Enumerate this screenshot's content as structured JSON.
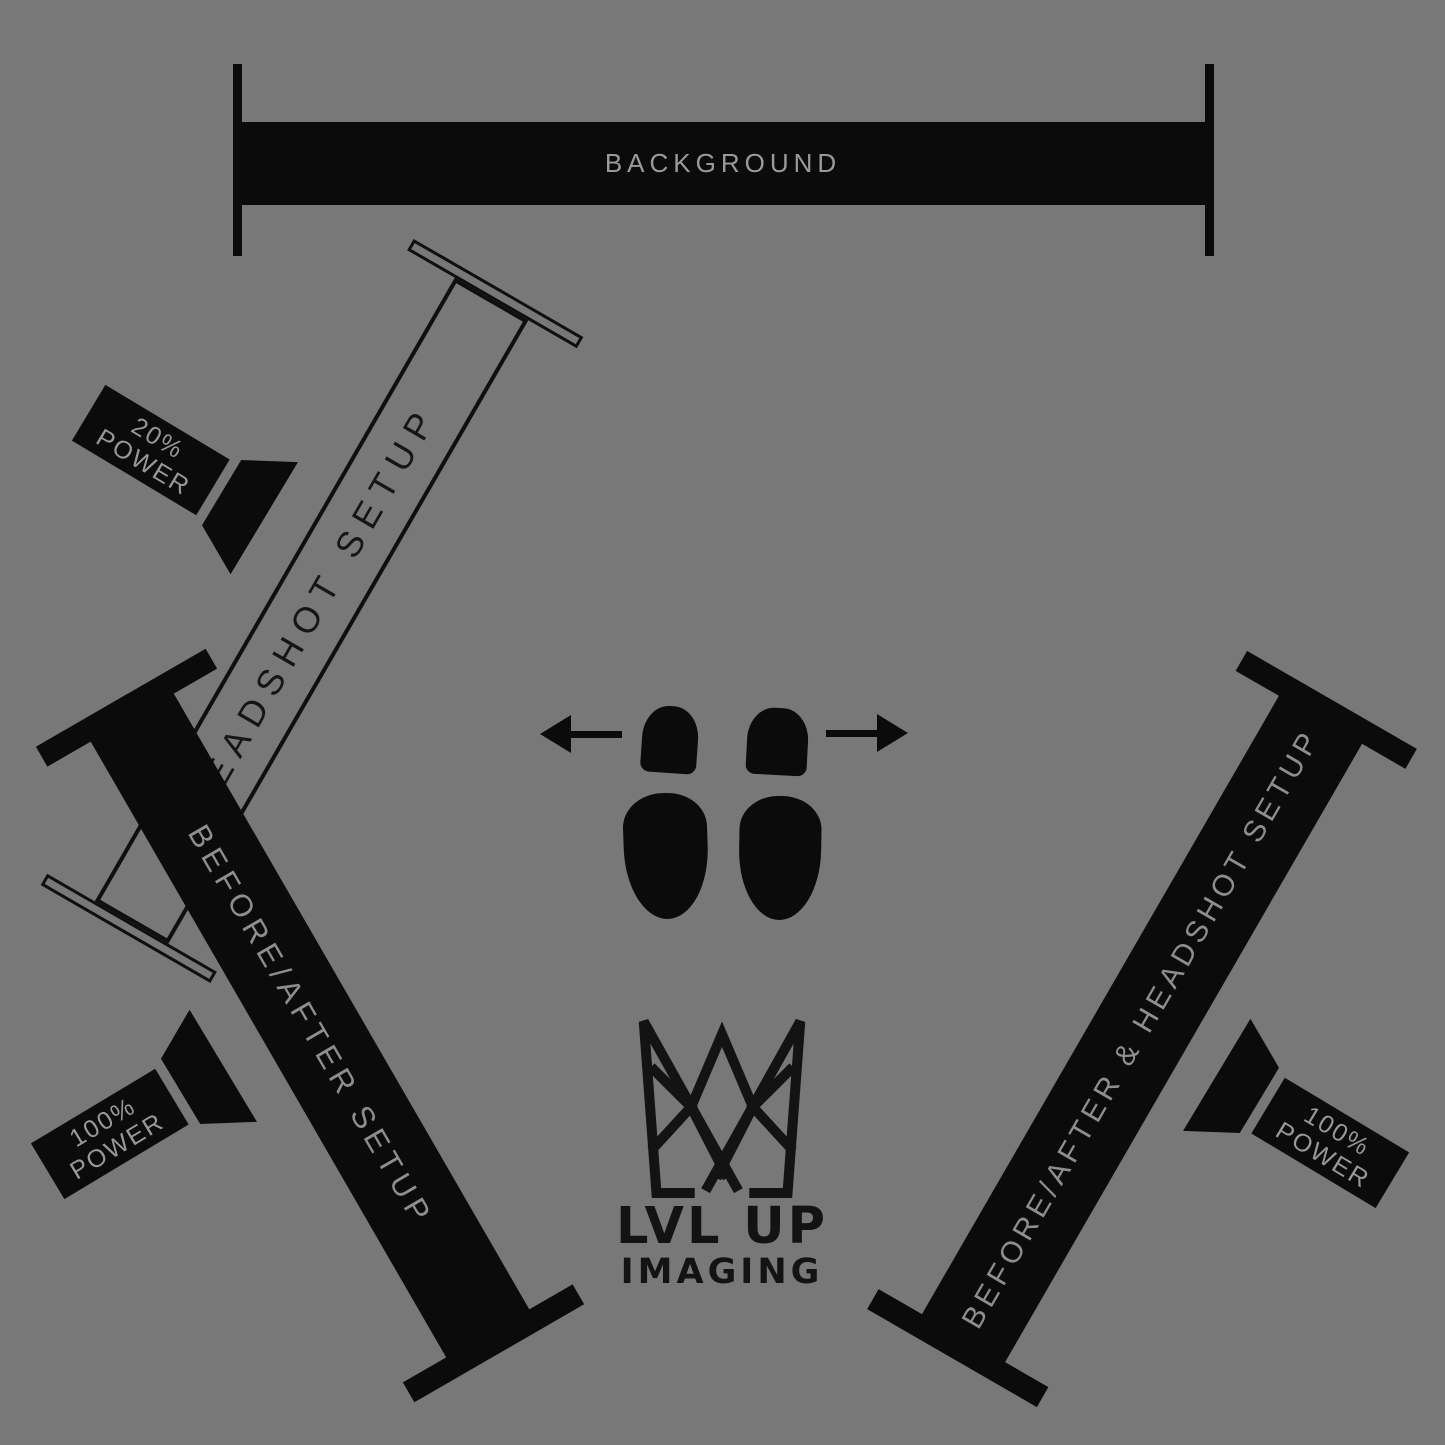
{
  "backdrop": {
    "label": "BACKGROUND"
  },
  "bars": {
    "headshot": {
      "label": "HEADSHOT SETUP"
    },
    "before_after": {
      "label": "BEFORE/AFTER SETUP"
    },
    "combo": {
      "label": "BEFORE/AFTER & HEADSHOT SETUP"
    }
  },
  "lights": {
    "key_top_left": {
      "power": "20%",
      "word": "POWER"
    },
    "bottom_left": {
      "power": "100%",
      "word": "POWER"
    },
    "bottom_right": {
      "power": "100%",
      "word": "POWER"
    }
  },
  "logo": {
    "line1": "LVL UP",
    "line2": "IMAGING"
  },
  "colors": {
    "background": "#787878",
    "ink": "#0b0b0b",
    "bar_label_gray": "#8e8e8e",
    "backdrop_label_gray": "#9a9a9a",
    "power_label_gray": "#989898"
  }
}
